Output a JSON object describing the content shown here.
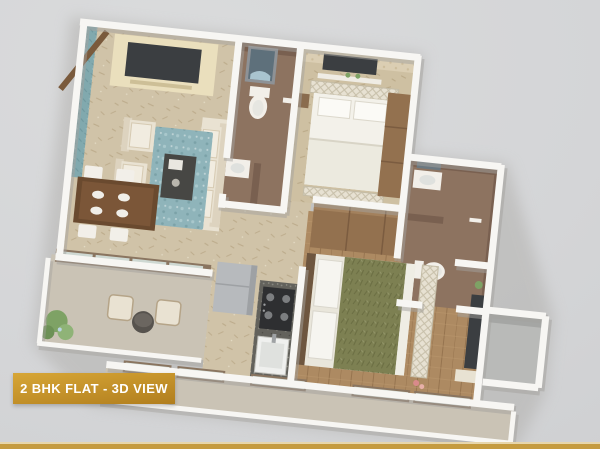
{
  "badge": {
    "label": "2 BHK FLAT - 3D VIEW"
  },
  "scene": {
    "type": "isometric-3d-floor-plan",
    "rooms": [
      "living-room",
      "dining-area",
      "kitchen",
      "bedroom-1",
      "master-bedroom",
      "bathroom-1",
      "bathroom-2",
      "sit-out-balcony",
      "bottom-balcony",
      "utility-shaft"
    ]
  },
  "palette": {
    "bg": "#d4d5d7",
    "gold_light": "#d7a636",
    "gold_dark": "#b17e1e",
    "bar_gold": "#c59b3f",
    "bar_light": "#e7d6ab",
    "label_text": "#ffffff",
    "wall_white": "#f7f6f3",
    "wall_shadow": "#a3a29e",
    "floor_beige": "#d0c3a8",
    "floor_wood": "#ad8a62",
    "bath_brown": "#8d7360",
    "bath_brown_dark": "#796050",
    "teal_wall": "#81a9ae",
    "rug_teal": "#8fb4ba",
    "cream_sofa": "#e9e2d2",
    "cream_panel": "#eadfbd",
    "tv_dark": "#3b3e41",
    "wood_dark": "#6a4a2f",
    "wardrobe_brown": "#93714f",
    "green_bed": "#7d8052",
    "plant_green": "#7ea265",
    "granite": "#63625c",
    "stove_dark": "#2e2f31",
    "fridge_gray": "#b7babd",
    "glass": "#d2ddd8",
    "glass_frame": "#8a7560",
    "balcony_floor": "#cac3b5",
    "white_furniture": "#f2efe9"
  }
}
